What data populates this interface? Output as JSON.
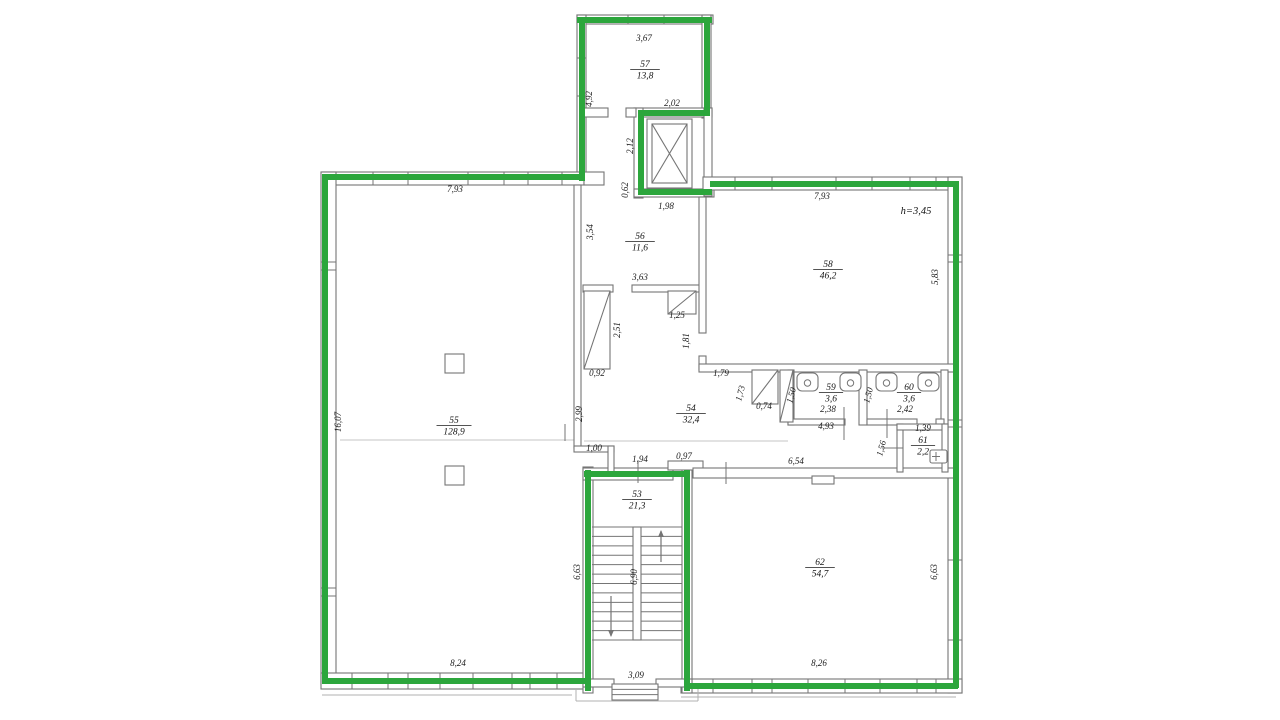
{
  "colors": {
    "wall": "#757575",
    "outline_green": "#2ca63c",
    "text": "#1b1b1b",
    "faint": "#c6c6c6",
    "porch": "#b0b0b0"
  },
  "plan": {
    "height_note": {
      "text": "h=3,45",
      "x": 916,
      "y": 214
    },
    "rooms": [
      {
        "number": "57",
        "area": "13,8",
        "x": 645,
        "y": 67
      },
      {
        "number": "56",
        "area": "11,6",
        "x": 640,
        "y": 239
      },
      {
        "number": "58",
        "area": "46,2",
        "x": 828,
        "y": 267
      },
      {
        "number": "55",
        "area": "128,9",
        "x": 454,
        "y": 423
      },
      {
        "number": "54",
        "area": "32,4",
        "x": 691,
        "y": 411
      },
      {
        "number": "59",
        "area": "3,6",
        "x": 831,
        "y": 390
      },
      {
        "number": "60",
        "area": "3,6",
        "x": 909,
        "y": 390
      },
      {
        "number": "61",
        "area": "2,2",
        "x": 923,
        "y": 443
      },
      {
        "number": "53",
        "area": "21,3",
        "x": 637,
        "y": 497
      },
      {
        "number": "62",
        "area": "54,7",
        "x": 820,
        "y": 565
      }
    ],
    "dims": [
      {
        "t": "3,67",
        "x": 644,
        "y": 41,
        "r": 0
      },
      {
        "t": "4,92",
        "x": 592,
        "y": 99,
        "r": -90
      },
      {
        "t": "2,02",
        "x": 672,
        "y": 106,
        "r": 0
      },
      {
        "t": "2,12",
        "x": 633,
        "y": 146,
        "r": -90
      },
      {
        "t": "0,62",
        "x": 628,
        "y": 190,
        "r": -90
      },
      {
        "t": "1,98",
        "x": 666,
        "y": 209,
        "r": 0
      },
      {
        "t": "3,54",
        "x": 593,
        "y": 232,
        "r": -90
      },
      {
        "t": "3,63",
        "x": 640,
        "y": 280,
        "r": 0
      },
      {
        "t": "7,93",
        "x": 455,
        "y": 192,
        "r": 0
      },
      {
        "t": "7,93",
        "x": 822,
        "y": 199,
        "r": 0
      },
      {
        "t": "5,83",
        "x": 938,
        "y": 277,
        "r": -90
      },
      {
        "t": "16,07",
        "x": 341,
        "y": 422,
        "r": -90
      },
      {
        "t": "2,51",
        "x": 620,
        "y": 330,
        "r": -90
      },
      {
        "t": "0,92",
        "x": 597,
        "y": 376,
        "r": 0
      },
      {
        "t": "1,25",
        "x": 677,
        "y": 318,
        "r": 0
      },
      {
        "t": "1,81",
        "x": 689,
        "y": 341,
        "r": -90
      },
      {
        "t": "2,99",
        "x": 582,
        "y": 414,
        "r": -90
      },
      {
        "t": "1,79",
        "x": 721,
        "y": 376,
        "r": 0
      },
      {
        "t": "1,73",
        "x": 743,
        "y": 394,
        "r": -75
      },
      {
        "t": "0,74",
        "x": 764,
        "y": 409,
        "r": 0
      },
      {
        "t": "1,50",
        "x": 794,
        "y": 396,
        "r": -75
      },
      {
        "t": "2,38",
        "x": 828,
        "y": 412,
        "r": 0
      },
      {
        "t": "1,50",
        "x": 871,
        "y": 396,
        "r": -75
      },
      {
        "t": "2,42",
        "x": 905,
        "y": 412,
        "r": 0
      },
      {
        "t": "4,93",
        "x": 826,
        "y": 429,
        "r": 0
      },
      {
        "t": "1,39",
        "x": 923,
        "y": 431,
        "r": 0
      },
      {
        "t": "1,56",
        "x": 884,
        "y": 449,
        "r": -75
      },
      {
        "t": "1,00",
        "x": 594,
        "y": 451,
        "r": 0
      },
      {
        "t": "1,94",
        "x": 640,
        "y": 462,
        "r": 0
      },
      {
        "t": "0,97",
        "x": 684,
        "y": 459,
        "r": 0
      },
      {
        "t": "6,54",
        "x": 796,
        "y": 464,
        "r": 0
      },
      {
        "t": "6,63",
        "x": 580,
        "y": 572,
        "r": -90
      },
      {
        "t": "6,90",
        "x": 637,
        "y": 577,
        "r": -90
      },
      {
        "t": "6,63",
        "x": 937,
        "y": 572,
        "r": -90
      },
      {
        "t": "8,24",
        "x": 458,
        "y": 666,
        "r": 0
      },
      {
        "t": "8,26",
        "x": 819,
        "y": 666,
        "r": 0
      },
      {
        "t": "3,09",
        "x": 636,
        "y": 678,
        "r": 0
      }
    ],
    "walls": [
      [
        577,
        15,
        136,
        9
      ],
      [
        577,
        15,
        9,
        166
      ],
      [
        702,
        15,
        9,
        103
      ],
      [
        634,
        108,
        78,
        9
      ],
      [
        634,
        108,
        9,
        90
      ],
      [
        634,
        189,
        80,
        8
      ],
      [
        704,
        108,
        8,
        88
      ],
      [
        584,
        108,
        24,
        9
      ],
      [
        626,
        108,
        10,
        9
      ],
      [
        322,
        172,
        262,
        13
      ],
      [
        321,
        172,
        15,
        513
      ],
      [
        321,
        673,
        271,
        16
      ],
      [
        703,
        177,
        259,
        13
      ],
      [
        948,
        177,
        14,
        516
      ],
      [
        681,
        679,
        281,
        14
      ],
      [
        583,
        467,
        10,
        226
      ],
      [
        682,
        467,
        10,
        226
      ],
      [
        583,
        468,
        90,
        12
      ],
      [
        668,
        461,
        35,
        9
      ],
      [
        693,
        468,
        262,
        10
      ],
      [
        574,
        185,
        7,
        263
      ],
      [
        574,
        446,
        40,
        6
      ],
      [
        608,
        446,
        6,
        30
      ],
      [
        583,
        285,
        30,
        7
      ],
      [
        632,
        285,
        68,
        7
      ],
      [
        584,
        172,
        20,
        13
      ],
      [
        699,
        197,
        7,
        136
      ],
      [
        699,
        356,
        7,
        14
      ],
      [
        699,
        364,
        257,
        8
      ],
      [
        788,
        370,
        6,
        55
      ],
      [
        859,
        370,
        8,
        55
      ],
      [
        941,
        370,
        7,
        55
      ],
      [
        788,
        419,
        57,
        6
      ],
      [
        867,
        419,
        50,
        6
      ],
      [
        936,
        419,
        8,
        6
      ],
      [
        897,
        424,
        6,
        48
      ],
      [
        897,
        424,
        51,
        6
      ],
      [
        942,
        424,
        6,
        48
      ],
      [
        583,
        679,
        31,
        8
      ],
      [
        656,
        679,
        36,
        8
      ],
      [
        812,
        476,
        22,
        8
      ]
    ],
    "wall_ticks": [
      [
        373,
        172,
        373,
        185
      ],
      [
        408,
        172,
        408,
        185
      ],
      [
        468,
        172,
        468,
        185
      ],
      [
        504,
        172,
        504,
        185
      ],
      [
        528,
        172,
        528,
        185
      ],
      [
        562,
        172,
        562,
        185
      ],
      [
        628,
        15,
        628,
        24
      ],
      [
        664,
        15,
        664,
        24
      ],
      [
        735,
        177,
        735,
        190
      ],
      [
        772,
        177,
        772,
        190
      ],
      [
        836,
        177,
        836,
        190
      ],
      [
        872,
        177,
        872,
        190
      ],
      [
        910,
        177,
        910,
        190
      ],
      [
        936,
        177,
        936,
        190
      ],
      [
        321,
        262,
        336,
        262
      ],
      [
        321,
        270,
        336,
        270
      ],
      [
        321,
        588,
        336,
        588
      ],
      [
        321,
        596,
        336,
        596
      ],
      [
        948,
        255,
        962,
        255
      ],
      [
        948,
        262,
        962,
        262
      ],
      [
        948,
        420,
        962,
        420
      ],
      [
        948,
        427,
        962,
        427
      ],
      [
        948,
        560,
        962,
        560
      ],
      [
        948,
        640,
        962,
        640
      ],
      [
        352,
        673,
        352,
        689
      ],
      [
        388,
        673,
        388,
        689
      ],
      [
        408,
        673,
        408,
        689
      ],
      [
        440,
        673,
        440,
        689
      ],
      [
        473,
        673,
        473,
        689
      ],
      [
        512,
        673,
        512,
        689
      ],
      [
        530,
        673,
        530,
        689
      ],
      [
        557,
        673,
        557,
        689
      ],
      [
        713,
        679,
        713,
        693
      ],
      [
        752,
        679,
        752,
        693
      ],
      [
        772,
        679,
        772,
        693
      ],
      [
        808,
        679,
        808,
        693
      ],
      [
        845,
        679,
        845,
        693
      ],
      [
        880,
        679,
        880,
        693
      ],
      [
        917,
        679,
        917,
        693
      ],
      [
        936,
        679,
        936,
        693
      ],
      [
        577,
        58,
        586,
        58
      ],
      [
        577,
        96,
        586,
        96
      ]
    ],
    "witness_ticks": [
      [
        638,
        460,
        638,
        483
      ],
      [
        726,
        462,
        726,
        484
      ],
      [
        844,
        407,
        844,
        440
      ],
      [
        887,
        409,
        887,
        438
      ],
      [
        565,
        424,
        565,
        441
      ],
      [
        882,
        448,
        903,
        448
      ]
    ],
    "faint_lines": [
      [
        340,
        440,
        574,
        440
      ],
      [
        584,
        441,
        788,
        441
      ]
    ],
    "porch_lines": [
      [
        322,
        695,
        572,
        695
      ],
      [
        681,
        697,
        956,
        697
      ],
      [
        576,
        689,
        576,
        701
      ],
      [
        576,
        701,
        698,
        701
      ],
      [
        698,
        701,
        698,
        689
      ]
    ],
    "shafts": [
      [
        584,
        291,
        26,
        78
      ],
      [
        668,
        291,
        28,
        23
      ],
      [
        752,
        370,
        26,
        34
      ],
      [
        780,
        370,
        13,
        52
      ]
    ],
    "columns": [
      [
        445,
        354,
        19,
        19
      ],
      [
        445,
        466,
        19,
        19
      ]
    ],
    "elevator": {
      "outer": [
        647,
        119,
        45,
        69
      ],
      "inner": [
        652,
        124,
        35,
        59
      ]
    },
    "stairs": {
      "x1": 592,
      "x2": 682,
      "top": 527,
      "bottom": 640,
      "treads": 12,
      "divider": [
        633,
        527,
        8,
        113
      ],
      "arrow_up": {
        "x": 661,
        "y1": 562,
        "y2": 531
      },
      "arrow_down": {
        "x": 611,
        "y1": 596,
        "y2": 636
      }
    },
    "entry_steps": {
      "x": 612,
      "y": 684,
      "w": 46,
      "h": 16,
      "rows": 2
    },
    "fixtures": {
      "toilets_y": 373,
      "toilets_x": [
        797,
        840,
        876,
        918
      ],
      "toilet_w": 21,
      "toilet_h": 18,
      "sink": [
        930,
        450,
        17,
        13
      ]
    },
    "green_segments": [
      [
        577,
        20,
        712,
        20
      ],
      [
        582,
        17,
        582,
        181
      ],
      [
        707,
        17,
        707,
        115
      ],
      [
        710,
        113,
        638,
        113
      ],
      [
        641,
        110,
        641,
        195
      ],
      [
        638,
        192,
        712,
        192
      ],
      [
        710,
        184,
        958,
        184
      ],
      [
        325,
        177,
        584,
        177
      ],
      [
        325,
        174,
        325,
        684
      ],
      [
        322,
        681,
        590,
        681
      ],
      [
        588,
        470,
        588,
        691
      ],
      [
        584,
        474,
        690,
        474
      ],
      [
        687,
        470,
        687,
        691
      ],
      [
        684,
        686,
        958,
        686
      ],
      [
        956,
        181,
        956,
        688
      ]
    ]
  }
}
